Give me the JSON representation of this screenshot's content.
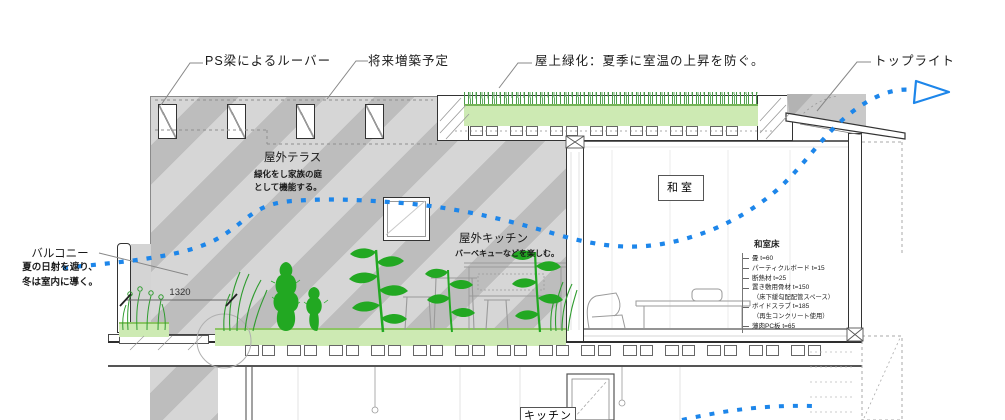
{
  "annotations": {
    "louver": "PS梁によるルーバー",
    "future": "将来増築予定",
    "green_roof": "屋上緑化：夏季に室温の上昇を防ぐ。",
    "toplight": "トップライト",
    "balcony": {
      "title": "バルコニー",
      "line1": "夏の日射を遮り、",
      "line2": "冬は室内に導く。"
    },
    "terrace": {
      "title": "屋外テラス",
      "line1": "緑化をし家族の庭",
      "line2": "として機能する。"
    },
    "outdoor_kitchen": {
      "title": "屋外キッチン",
      "line1": "バーベキューなどを楽しむ。"
    }
  },
  "rooms": {
    "washitsu": "和室",
    "kitchen": "キッチン"
  },
  "dimension": {
    "value": "1320"
  },
  "floor_spec": {
    "title": "和室床",
    "items": [
      "畳 t=60",
      "パーティクルボード t=15",
      "断熱材 t=25",
      "置き敷用骨材 t=150",
      "（床下緩勾配配管スペース）",
      "ボイドスラブ t=185",
      "（再生コンクリート使用）",
      "薄肉PC板 t=65"
    ]
  },
  "icons": {
    "airflow_arrow": "triangle-right-outline"
  },
  "colors": {
    "accent_blue": "#1d86ea",
    "plant_green": "#22a822",
    "surface_green": "#cdeab3",
    "hatch_gray": "#bdbdbd"
  }
}
